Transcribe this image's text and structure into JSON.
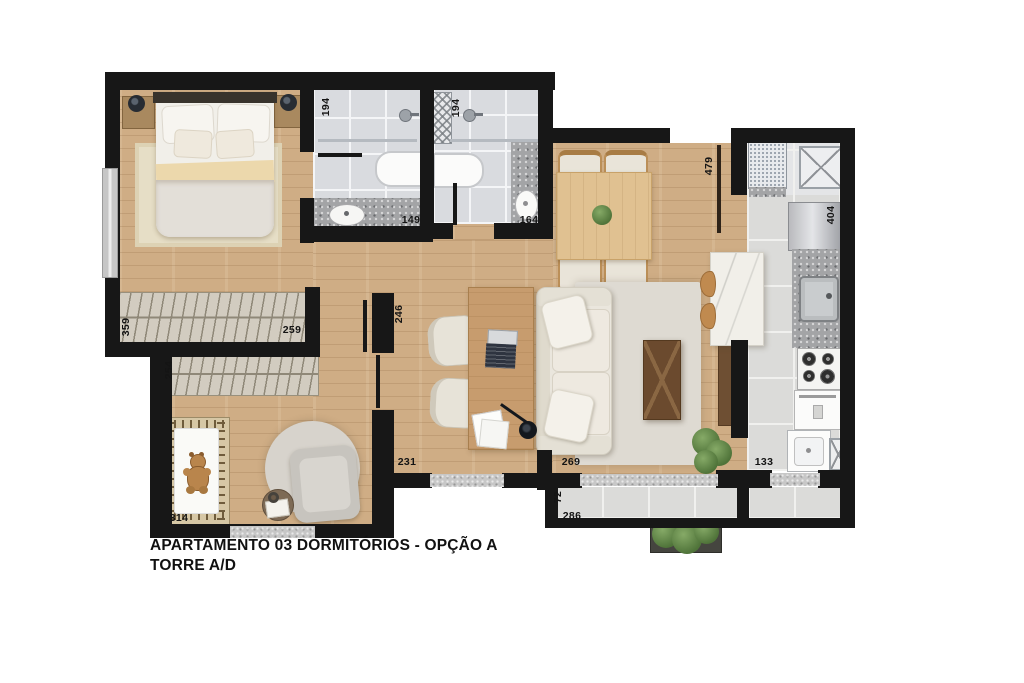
{
  "title": {
    "line1": "APARTAMENTO 03 DORMITÓRIOS - OPÇÃO A",
    "line2": "TORRE A/D"
  },
  "measurements": {
    "bath1_width": "194",
    "bath2_width": "194",
    "bath1_length": "149",
    "bath2_length": "164",
    "social_width": "479",
    "kitchen_length": "404",
    "bedroom_length": "359",
    "wardrobe1_length": "259",
    "wardrobe2_length": "254",
    "office_width": "246",
    "office_window": "231",
    "living_door": "269",
    "balcony_depth": "72",
    "balcony_length": "286",
    "kitchen_access": "133",
    "nursery_width": "314"
  },
  "colors": {
    "wall": "#171717",
    "wood_floor": "#cfad85",
    "tile_floor": "#dbdbd9",
    "granite": "#a3a4a6",
    "plant_green": "#4f7339",
    "label_text": "#141414"
  }
}
